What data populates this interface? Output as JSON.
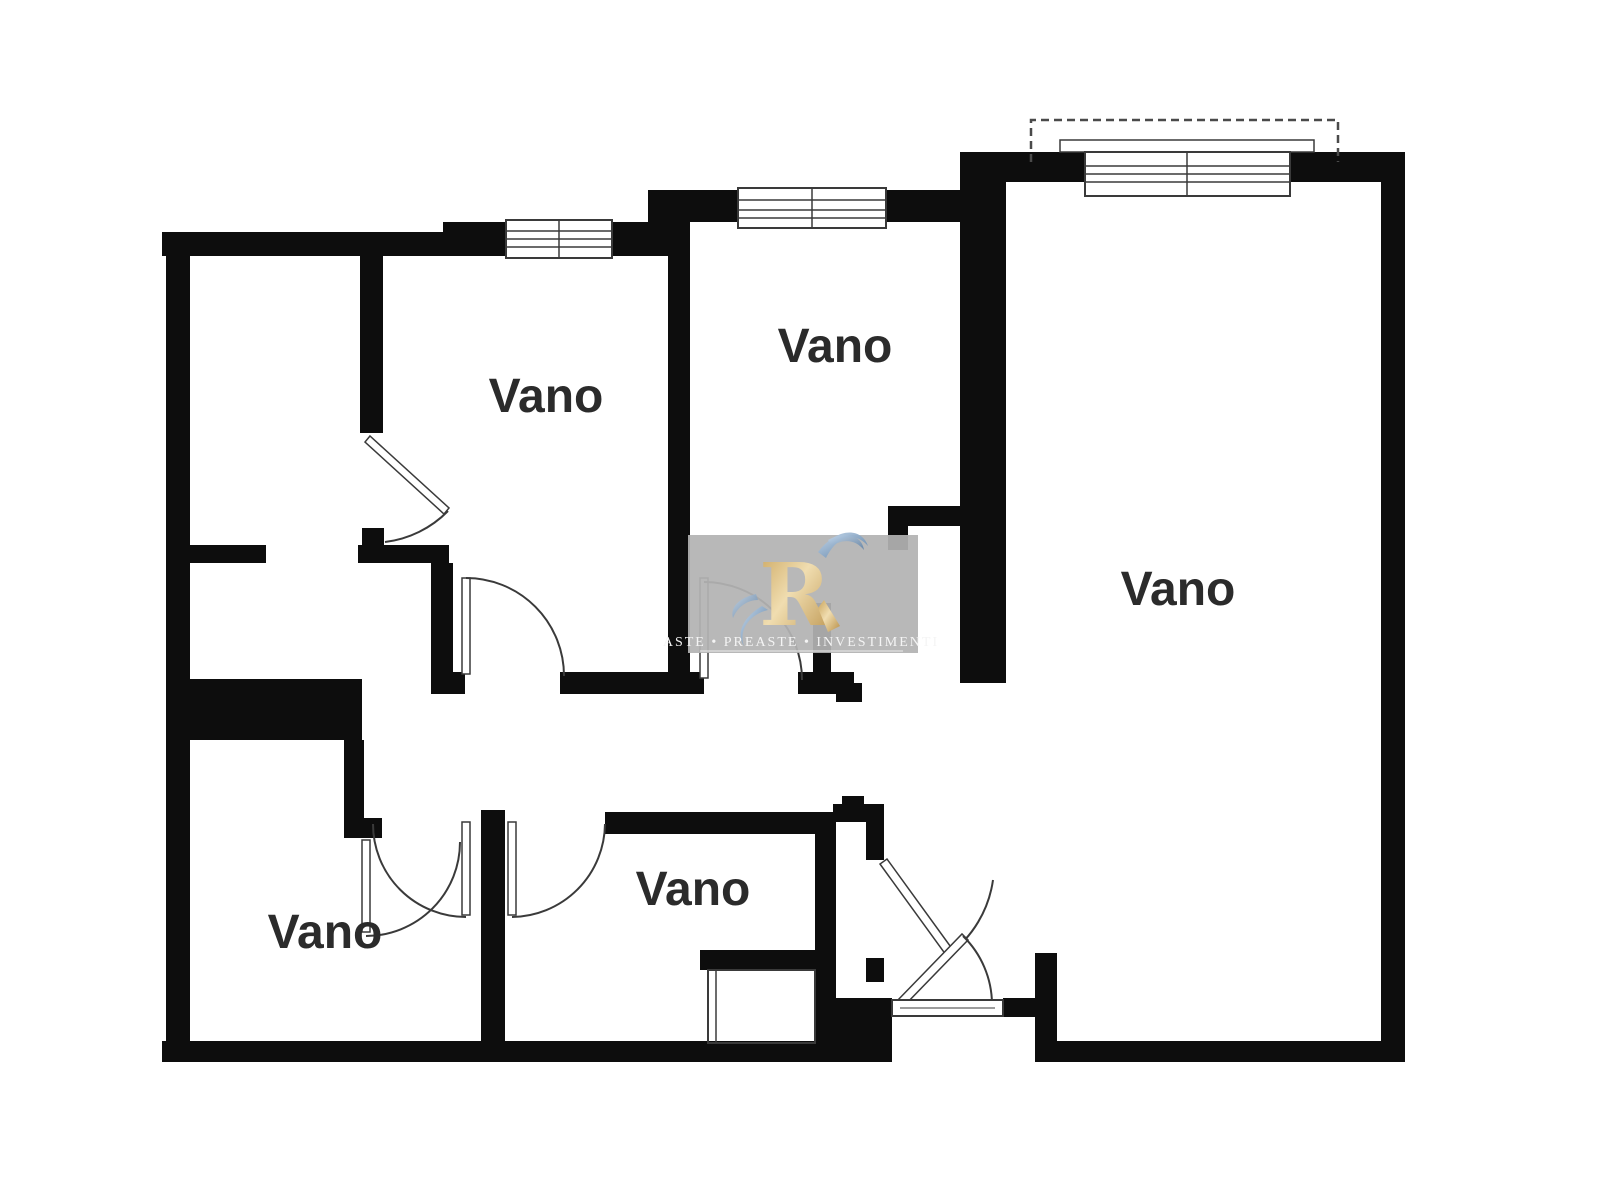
{
  "page": {
    "background": "#ffffff"
  },
  "plan": {
    "wall_color": "#0d0d0d",
    "line_color": "#3a3a3a",
    "label_color": "#2b2b2b",
    "rooms": [
      {
        "id": "room-top-left-vano",
        "label": "Vano"
      },
      {
        "id": "room-top-middle-vano",
        "label": "Vano"
      },
      {
        "id": "room-right-vano",
        "label": "Vano"
      },
      {
        "id": "room-bottom-left-vano",
        "label": "Vano"
      },
      {
        "id": "room-bottom-middle-vano",
        "label": "Vano"
      }
    ]
  },
  "watermark": {
    "words": [
      "Aste",
      "Preaste",
      "Investimenti"
    ],
    "separator": "•",
    "background": "#b3b3b3",
    "text_color": "#f4f4f4",
    "logo": {
      "letter": "R",
      "gold": "#d4ab63",
      "blue": "#7fa3c9"
    }
  }
}
